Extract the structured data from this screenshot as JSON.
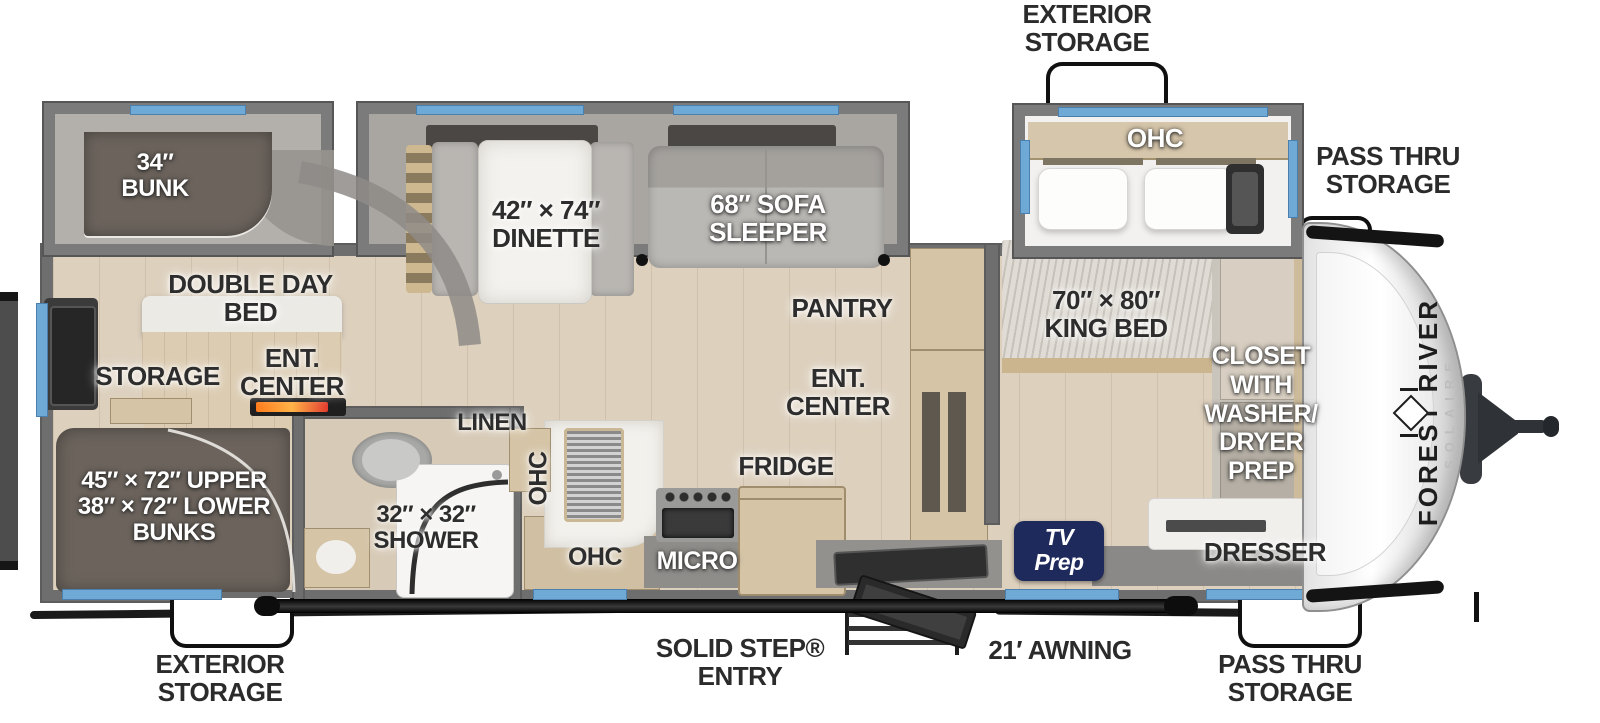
{
  "title": "Forest River Solaire travel trailer floor plan",
  "brand": {
    "manufacturer": "FOREST RIVER",
    "model": "SOLAIRE"
  },
  "exterior_labels": {
    "exterior_storage_top": "EXTERIOR\nSTORAGE",
    "pass_thru_storage_top": "PASS THRU\nSTORAGE",
    "pass_thru_storage_bottom": "PASS THRU\nSTORAGE",
    "exterior_storage_bottom": "EXTERIOR\nSTORAGE",
    "solid_step_entry": "SOLID STEP®\nENTRY",
    "awning": "21′ AWNING"
  },
  "interior_labels": {
    "bunk_34": "34″\nBUNK",
    "dinette": "42″ × 74″\nDINETTE",
    "sofa_sleeper": "68″ SOFA\nSLEEPER",
    "double_day_bed": "DOUBLE DAY\nBED",
    "pantry": "PANTRY",
    "king_bed": "70″ × 80″\nKING BED",
    "storage": "STORAGE",
    "ent_center_bunkroom": "ENT.\nCENTER",
    "ent_center_bedroom": "ENT.\nCENTER",
    "closet_washer_dryer": "CLOSET\nWITH\nWASHER/\nDRYER\nPREP",
    "bunks": "45″ × 72″ UPPER\n38″ × 72″ LOWER\nBUNKS",
    "shower": "32″ × 32″\nSHOWER",
    "linen": "LINEN",
    "ohc_bedroom": "OHC",
    "ohc_kitchen_wall": "OHC",
    "ohc_kitchen_lower": "OHC",
    "fridge": "FRIDGE",
    "micro": "MICRO",
    "tv_prep": "TV\nPrep",
    "dresser": "DRESSER"
  },
  "colors": {
    "wall_gray": "#6e6e6e",
    "floor_tan": "#ddd0bd",
    "window_blue": "#6fa9d6",
    "bunk_dark": "#6b635c",
    "cabinet_tan": "#d5c4a6",
    "tv_prep_navy": "#1f2a5c",
    "label_dark": "#2d2d2d",
    "label_light": "#ffffff"
  }
}
